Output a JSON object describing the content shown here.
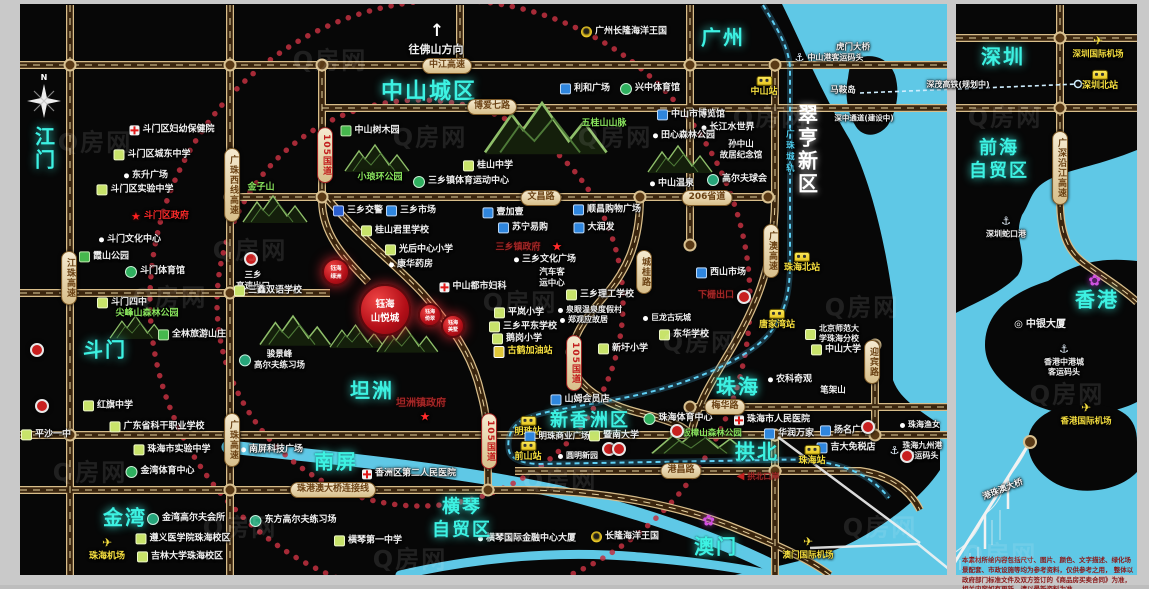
{
  "meta": {
    "watermark": "Q房网",
    "disclaimer": {
      "line1": "本素材所绘内容包括尺寸、图片、颜色、文字描述、绿化场景配套、市政设施等均为参考资料，仅供参考之用，",
      "line2": "整体以政府部门标准文件及双方签订的《商品房买卖合同》为准，相关内容如有更新，请以最新资料为准。"
    }
  },
  "colors": {
    "water": "#5fc8e6",
    "road_casing": "#d7bd8a",
    "accent_red": "#c81f1f",
    "region_cyan": "#3df2e2"
  },
  "project": {
    "main": {
      "t": "钰海\n山悦城",
      "x": 385,
      "y": 310,
      "r": 24,
      "fs": 9.5
    },
    "subs": [
      {
        "t": "钰海\n绿洲",
        "x": 336,
        "y": 272,
        "r": 12,
        "fs": 5.5
      },
      {
        "t": "钰海\n倚翠",
        "x": 430,
        "y": 315,
        "r": 10,
        "fs": 5
      },
      {
        "t": "钰海\n美墅",
        "x": 453,
        "y": 326,
        "r": 10,
        "fs": 5
      }
    ]
  },
  "misc": {
    "north": "N",
    "direction": "往佛山方向",
    "up_arrow": "↑"
  },
  "regions": [
    {
      "t": "江门",
      "x": 43,
      "y": 149,
      "v": 1
    },
    {
      "t": "斗门",
      "x": 105,
      "y": 350
    },
    {
      "t": "金湾",
      "x": 125,
      "y": 518
    },
    {
      "t": "中山城区",
      "x": 429,
      "y": 92,
      "s": 22
    },
    {
      "t": "坦洲",
      "x": 372,
      "y": 391
    },
    {
      "t": "南屏",
      "x": 336,
      "y": 462
    },
    {
      "t": "横琴\n自贸区",
      "x": 462,
      "y": 519,
      "s": 18
    },
    {
      "t": "新香洲区",
      "x": 590,
      "y": 421,
      "s": 18
    },
    {
      "t": "珠海",
      "x": 738,
      "y": 387
    },
    {
      "t": "拱北",
      "x": 757,
      "y": 452
    },
    {
      "t": "澳门",
      "x": 716,
      "y": 547
    },
    {
      "t": "广州",
      "x": 723,
      "y": 38
    },
    {
      "t": "翠亨新区",
      "x": 806,
      "y": 150,
      "v": 1,
      "white": 1
    },
    {
      "t": "深圳",
      "x": 1003,
      "y": 57
    },
    {
      "t": "前海\n自贸区",
      "x": 999,
      "y": 160,
      "s": 18
    },
    {
      "t": "香港",
      "x": 1097,
      "y": 300
    }
  ],
  "pills": [
    {
      "t": "中江高速",
      "x": 447,
      "y": 66
    },
    {
      "t": "博爱七路",
      "x": 492,
      "y": 107
    },
    {
      "t": "文昌路",
      "x": 541,
      "y": 198
    },
    {
      "t": "206省道",
      "x": 707,
      "y": 198
    },
    {
      "t": "梅华路",
      "x": 725,
      "y": 407
    },
    {
      "t": "港昌路",
      "x": 681,
      "y": 471
    },
    {
      "t": "珠港澳大桥连接线",
      "x": 333,
      "y": 490
    },
    {
      "t": "105国道",
      "x": 325,
      "y": 155,
      "v": 1,
      "red": 1
    },
    {
      "t": "105国道",
      "x": 489,
      "y": 441,
      "v": 1,
      "red": 1
    },
    {
      "t": "105国道",
      "x": 574,
      "y": 363,
      "v": 1,
      "red": 1
    },
    {
      "t": "广珠西线高速",
      "x": 232,
      "y": 185,
      "v": 1
    },
    {
      "t": "江珠高速",
      "x": 69,
      "y": 278,
      "v": 1
    },
    {
      "t": "广珠高速",
      "x": 232,
      "y": 440,
      "v": 1
    },
    {
      "t": "城桂路",
      "x": 644,
      "y": 272,
      "v": 1
    },
    {
      "t": "广澳高速",
      "x": 771,
      "y": 251,
      "v": 1
    },
    {
      "t": "迎宾路",
      "x": 872,
      "y": 362,
      "v": 1
    },
    {
      "t": "广深沿江高速",
      "x": 1060,
      "y": 168,
      "v": 1
    }
  ],
  "places": [
    {
      "t": "斗门区妇幼保健院",
      "x": 172,
      "y": 130,
      "ic": "hosp"
    },
    {
      "t": "斗门区城东中学",
      "x": 152,
      "y": 155,
      "ic": "school"
    },
    {
      "t": "东升广场",
      "x": 146,
      "y": 176,
      "ic": "dot"
    },
    {
      "t": "斗门区实验中学",
      "x": 135,
      "y": 190,
      "ic": "school"
    },
    {
      "t": "斗门区政府",
      "x": 160,
      "y": 217,
      "ic": "star",
      "c": "r"
    },
    {
      "t": "斗门文化中心",
      "x": 130,
      "y": 240,
      "ic": "dot"
    },
    {
      "t": "霞山公园",
      "x": 104,
      "y": 257,
      "ic": "park"
    },
    {
      "t": "斗门体育馆",
      "x": 155,
      "y": 272,
      "ic": "sport"
    },
    {
      "t": "斗门四中",
      "x": 122,
      "y": 303,
      "ic": "school"
    },
    {
      "t": "尖峰山森林公园",
      "x": 147,
      "y": 314,
      "c": "g"
    },
    {
      "t": "全林旅游山庄",
      "x": 192,
      "y": 335,
      "ic": "park"
    },
    {
      "t": "红旗中学",
      "x": 108,
      "y": 406,
      "ic": "school"
    },
    {
      "t": "广东省科干职业学校",
      "x": 157,
      "y": 427,
      "ic": "school"
    },
    {
      "t": "珠海市实验中学",
      "x": 172,
      "y": 450,
      "ic": "school"
    },
    {
      "t": "金湾体育中心",
      "x": 160,
      "y": 472,
      "ic": "sport"
    },
    {
      "t": "平沙一中",
      "x": 46,
      "y": 435,
      "ic": "school"
    },
    {
      "t": "金湾高尔夫会所",
      "x": 186,
      "y": 519,
      "ic": "golf"
    },
    {
      "t": "遵义医学院珠海校区",
      "x": 183,
      "y": 539,
      "ic": "school"
    },
    {
      "t": "吉林大学珠海校区",
      "x": 180,
      "y": 557,
      "ic": "school"
    },
    {
      "t": "珠海机场",
      "x": 107,
      "y": 549,
      "ic": "plane",
      "st": 1,
      "c": "y"
    },
    {
      "t": "金子山",
      "x": 261,
      "y": 188,
      "c": "g"
    },
    {
      "t": "三乡\n高速出口",
      "x": 253,
      "y": 281,
      "fs": 8.5
    },
    {
      "t": "三鑫双语学校",
      "x": 268,
      "y": 291,
      "ic": "school"
    },
    {
      "t": "骏景峰\n高尔夫练习场",
      "x": 272,
      "y": 360,
      "ic": "golf",
      "fs": 8.5
    },
    {
      "t": "中山树木园",
      "x": 370,
      "y": 131,
      "ic": "park"
    },
    {
      "t": "小琅环公园",
      "x": 380,
      "y": 178,
      "c": "g"
    },
    {
      "t": "三乡镇体育运动中心",
      "x": 461,
      "y": 182,
      "ic": "sport"
    },
    {
      "t": "桂山中学",
      "x": 488,
      "y": 166,
      "ic": "school"
    },
    {
      "t": "五桂山山脉",
      "x": 604,
      "y": 124,
      "c": "g"
    },
    {
      "t": "三乡交警",
      "x": 358,
      "y": 211,
      "ic": "police"
    },
    {
      "t": "三乡市场",
      "x": 411,
      "y": 211,
      "ic": "shop"
    },
    {
      "t": "壹加壹",
      "x": 503,
      "y": 213,
      "ic": "shop"
    },
    {
      "t": "苏宁易购",
      "x": 523,
      "y": 228,
      "ic": "shop"
    },
    {
      "t": "大润发",
      "x": 594,
      "y": 228,
      "ic": "shop"
    },
    {
      "t": "顺昌购物广场",
      "x": 607,
      "y": 210,
      "ic": "shop"
    },
    {
      "t": "桂山君里学校",
      "x": 395,
      "y": 231,
      "ic": "school"
    },
    {
      "t": "光后中心小学",
      "x": 419,
      "y": 250,
      "ic": "school"
    },
    {
      "t": "康华药房",
      "x": 411,
      "y": 265,
      "ic": "dot"
    },
    {
      "t": "三乡镇政府",
      "x": 518,
      "y": 248,
      "c": "dr"
    },
    {
      "t": "★",
      "x": 557,
      "y": 247,
      "c": "r",
      "fs": 12
    },
    {
      "t": "三乡文化广场",
      "x": 545,
      "y": 260,
      "ic": "dot"
    },
    {
      "t": "汽车客\n运中心",
      "x": 552,
      "y": 278,
      "fs": 8.5
    },
    {
      "t": "中山都市妇科",
      "x": 473,
      "y": 287,
      "ic": "hosp"
    },
    {
      "t": "三乡理工学校",
      "x": 600,
      "y": 295,
      "ic": "school"
    },
    {
      "t": "泉眼温泉度假村",
      "x": 590,
      "y": 310,
      "ic": "dot",
      "fs": 8
    },
    {
      "t": "郑观应故居",
      "x": 584,
      "y": 320,
      "ic": "dot",
      "fs": 8
    },
    {
      "t": "巨龙古玩城",
      "x": 667,
      "y": 318,
      "ic": "dot",
      "fs": 8
    },
    {
      "t": "平岚小学",
      "x": 519,
      "y": 313,
      "ic": "school"
    },
    {
      "t": "三乡平东学校",
      "x": 523,
      "y": 327,
      "ic": "school"
    },
    {
      "t": "鹅岗小学",
      "x": 517,
      "y": 339,
      "ic": "school"
    },
    {
      "t": "古鹤加油站",
      "x": 523,
      "y": 352,
      "ic": "gas",
      "c": "y"
    },
    {
      "t": "东华学校",
      "x": 684,
      "y": 335,
      "ic": "school"
    },
    {
      "t": "新圩小学",
      "x": 623,
      "y": 349,
      "ic": "school"
    },
    {
      "t": "西山市场",
      "x": 721,
      "y": 273,
      "ic": "shop"
    },
    {
      "t": "下栅出口",
      "x": 716,
      "y": 296,
      "c": "dr"
    },
    {
      "t": "中山温泉",
      "x": 672,
      "y": 184,
      "ic": "dot"
    },
    {
      "t": "高尔夫球会",
      "x": 737,
      "y": 180,
      "ic": "golf"
    },
    {
      "t": "孙中山\n故居纪念馆",
      "x": 741,
      "y": 150,
      "fs": 8.5
    },
    {
      "t": "长江水世界",
      "x": 728,
      "y": 128,
      "ic": "dot"
    },
    {
      "t": "田心森林公园",
      "x": 684,
      "y": 136,
      "ic": "dot"
    },
    {
      "t": "中山市博览馆",
      "x": 691,
      "y": 115,
      "ic": "shop"
    },
    {
      "t": "利和广场",
      "x": 585,
      "y": 89,
      "ic": "shop"
    },
    {
      "t": "兴中体育馆",
      "x": 650,
      "y": 89,
      "ic": "sport"
    },
    {
      "t": "广州长隆海洋王国",
      "x": 624,
      "y": 32,
      "ic": "e"
    },
    {
      "t": "中山站",
      "x": 764,
      "y": 87,
      "ic": "train",
      "st": 1,
      "c": "y"
    },
    {
      "t": "马鞍岛",
      "x": 843,
      "y": 91,
      "fs": 8.5
    },
    {
      "t": "虎门大桥",
      "x": 853,
      "y": 48,
      "fs": 8.5
    },
    {
      "t": "中山港客运码头",
      "x": 829,
      "y": 58,
      "ic": "anchor",
      "fs": 8
    },
    {
      "t": "深中通道(建设中)",
      "x": 864,
      "y": 118,
      "fs": 7.5
    },
    {
      "t": "深茂高铁(规划中)",
      "x": 958,
      "y": 85,
      "fs": 8
    },
    {
      "t": "珠海北站",
      "x": 802,
      "y": 263,
      "ic": "train",
      "st": 1,
      "c": "y"
    },
    {
      "t": "唐家湾站",
      "x": 777,
      "y": 320,
      "ic": "train",
      "st": 1,
      "c": "y"
    },
    {
      "t": "北京师范大\n学珠海分校",
      "x": 832,
      "y": 334,
      "ic": "school",
      "fs": 8
    },
    {
      "t": "中山大学",
      "x": 836,
      "y": 350,
      "ic": "school"
    },
    {
      "t": "农科奇观",
      "x": 790,
      "y": 380,
      "ic": "dot"
    },
    {
      "t": "笔架山",
      "x": 833,
      "y": 391,
      "fs": 8.5
    },
    {
      "t": "珠海市人民医院",
      "x": 772,
      "y": 420,
      "ic": "hosp"
    },
    {
      "t": "华润万家",
      "x": 789,
      "y": 434,
      "ic": "shop"
    },
    {
      "t": "扬名广场",
      "x": 845,
      "y": 431,
      "ic": "shop"
    },
    {
      "t": "吉大免税店",
      "x": 846,
      "y": 448,
      "ic": "shop"
    },
    {
      "t": "珠海站",
      "x": 812,
      "y": 456,
      "ic": "train",
      "st": 1,
      "c": "y"
    },
    {
      "t": "珠海渔女",
      "x": 920,
      "y": 425,
      "ic": "dot",
      "fs": 8
    },
    {
      "t": "珠海九州港\n客运码头",
      "x": 916,
      "y": 451,
      "ic": "anchor",
      "fs": 8
    },
    {
      "t": "山姆会员店",
      "x": 580,
      "y": 400,
      "ic": "shop"
    },
    {
      "t": "明珠站",
      "x": 528,
      "y": 427,
      "ic": "train",
      "st": 1,
      "c": "y"
    },
    {
      "t": "明珠商业广场",
      "x": 557,
      "y": 437,
      "ic": "shop",
      "fs": 8.5
    },
    {
      "t": "前山站",
      "x": 528,
      "y": 452,
      "ic": "train",
      "st": 1,
      "c": "y"
    },
    {
      "t": "圆明新园",
      "x": 578,
      "y": 456,
      "ic": "dot",
      "fs": 8
    },
    {
      "t": "暨南大学",
      "x": 614,
      "y": 436,
      "ic": "school"
    },
    {
      "t": "珠海体育中心",
      "x": 678,
      "y": 419,
      "ic": "sport"
    },
    {
      "t": "板樟山森林公园",
      "x": 712,
      "y": 434,
      "c": "g",
      "fs": 8.5
    },
    {
      "t": "坦洲镇政府",
      "x": 421,
      "y": 404,
      "c": "dr",
      "fs": 10
    },
    {
      "t": "★",
      "x": 425,
      "y": 417,
      "c": "r",
      "fs": 12
    },
    {
      "t": "香洲区第二人民医院",
      "x": 409,
      "y": 474,
      "ic": "hosp"
    },
    {
      "t": "南屏科技广场",
      "x": 272,
      "y": 450,
      "ic": "dot"
    },
    {
      "t": "东方高尔夫练习场",
      "x": 293,
      "y": 521,
      "ic": "golf"
    },
    {
      "t": "横琴第一中学",
      "x": 368,
      "y": 541,
      "ic": "school"
    },
    {
      "t": "横琴国际金融中心大厦",
      "x": 527,
      "y": 539,
      "ic": "dot"
    },
    {
      "t": "长隆海洋王国",
      "x": 625,
      "y": 537,
      "ic": "e"
    },
    {
      "t": "澳门国际机场",
      "x": 808,
      "y": 548,
      "ic": "plane",
      "st": 1,
      "c": "y",
      "fs": 8.5
    },
    {
      "t": "拱北口岸",
      "x": 758,
      "y": 477,
      "ic": "arrowL",
      "c": "dr",
      "fs": 8
    },
    {
      "t": "",
      "x": 710,
      "y": 521,
      "ic": "flower"
    },
    {
      "t": "",
      "x": 1096,
      "y": 281,
      "ic": "flower"
    },
    {
      "t": "中银大厦",
      "x": 1040,
      "y": 325,
      "ic": "ring",
      "fs": 10
    },
    {
      "t": "香港中港城\n客运码头",
      "x": 1064,
      "y": 360,
      "ic": "anchor",
      "st": 1,
      "fs": 8
    },
    {
      "t": "香港国际机场",
      "x": 1086,
      "y": 414,
      "ic": "plane",
      "st": 1,
      "c": "y",
      "fs": 8.5
    },
    {
      "t": "深圳国际机场",
      "x": 1098,
      "y": 47,
      "ic": "plane",
      "st": 1,
      "c": "y",
      "fs": 8.5
    },
    {
      "t": "深圳北站",
      "x": 1100,
      "y": 81,
      "ic": "train",
      "st": 1,
      "c": "y"
    },
    {
      "t": "深圳蛇口港",
      "x": 1006,
      "y": 227,
      "ic": "anchor",
      "st": 1,
      "fs": 8
    },
    {
      "t": "港珠澳大桥",
      "x": 1003,
      "y": 490,
      "rot": -22,
      "fs": 8.5
    },
    {
      "t": "广珠城轨",
      "x": 789,
      "y": 152,
      "c": "cy",
      "v": 1,
      "fs": 8.5
    }
  ],
  "badges": [
    {
      "x": 251,
      "y": 259
    },
    {
      "x": 744,
      "y": 297
    },
    {
      "x": 868,
      "y": 427
    },
    {
      "x": 907,
      "y": 456
    },
    {
      "x": 609,
      "y": 449
    },
    {
      "x": 619,
      "y": 449
    },
    {
      "x": 677,
      "y": 431
    },
    {
      "x": 37,
      "y": 350
    },
    {
      "x": 42,
      "y": 406
    }
  ],
  "watermarks": [
    {
      "x": 95,
      "y": 140
    },
    {
      "x": 330,
      "y": 58
    },
    {
      "x": 170,
      "y": 295
    },
    {
      "x": 430,
      "y": 135
    },
    {
      "x": 90,
      "y": 470
    },
    {
      "x": 250,
      "y": 248
    },
    {
      "x": 520,
      "y": 300
    },
    {
      "x": 615,
      "y": 135
    },
    {
      "x": 700,
      "y": 340
    },
    {
      "x": 560,
      "y": 478
    },
    {
      "x": 770,
      "y": 115
    },
    {
      "x": 862,
      "y": 305
    },
    {
      "x": 880,
      "y": 525
    },
    {
      "x": 410,
      "y": 557
    },
    {
      "x": 1005,
      "y": 115
    },
    {
      "x": 1067,
      "y": 392
    },
    {
      "x": 1000,
      "y": 552
    },
    {
      "x": 240,
      "y": 525
    }
  ]
}
